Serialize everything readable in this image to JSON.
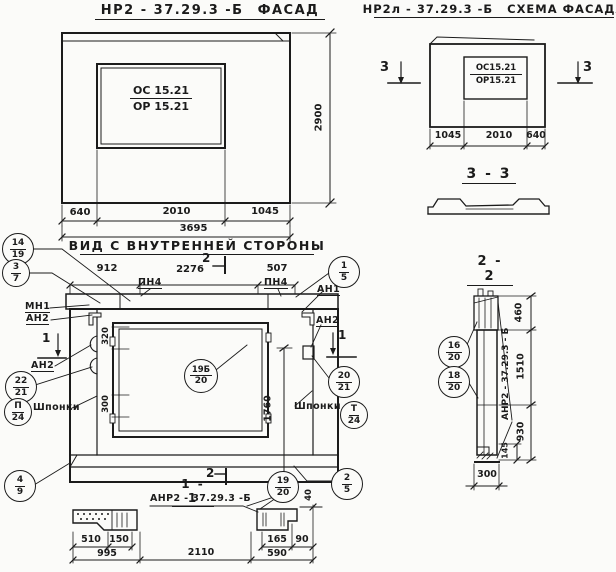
{
  "facade": {
    "title_number": "НР2 - 37.29.3  -Б",
    "title_word": "ФАСАД",
    "window_mark_top": "ОС 15.21",
    "window_mark_bottom": "ОР 15.21",
    "dim_height": "2900",
    "dim_left": "640",
    "dim_mid": "2010",
    "dim_right": "1045",
    "dim_total": "3695"
  },
  "scheme": {
    "title_number": "НР2л - 37.29.3  -Б",
    "title_word": "СХЕМА ФАСАДА",
    "window_mark_top": "ОС15.21",
    "window_mark_bottom": "ОР15.21",
    "dim_left": "1045",
    "dim_mid": "2010",
    "dim_right": "640",
    "section_mark": "3"
  },
  "section33": {
    "title": "3 - 3"
  },
  "section22": {
    "title": "2 - 2",
    "dim_top": "460",
    "dim_mid": "1510",
    "dim_bottom": "930",
    "dim_small": "145",
    "dim_width": "300",
    "panel_label": "АНР2 - 37.29.3 - Б",
    "callout_upper": {
      "top": "16",
      "bottom": "20"
    },
    "callout_lower": {
      "top": "18",
      "bottom": "20"
    }
  },
  "inner_view": {
    "title": "ВИД С ВНУТРЕННЕЙ  СТОРОНЫ",
    "dim_left": "912",
    "dim_mid": "2276",
    "dim_right": "507",
    "dim_height": "1760",
    "dim_hinge_top": "320",
    "dim_hinge_bottom": "300",
    "section_mark_1": "1",
    "section_mark_2": "2",
    "labels": {
      "pn4": "ПН4",
      "mn1": "МН1",
      "an1": "АН1",
      "an2": "АН2",
      "shponki": "Шпонки"
    },
    "callouts": {
      "c14_19": {
        "top": "14",
        "bottom": "19"
      },
      "c3_7": {
        "top": "3",
        "bottom": "7"
      },
      "c22_21": {
        "top": "22",
        "bottom": "21"
      },
      "cp_24": {
        "top": "П",
        "bottom": "24"
      },
      "c4_9": {
        "top": "4",
        "bottom": "9"
      },
      "c1_5": {
        "top": "1",
        "bottom": "5"
      },
      "c20_21": {
        "top": "20",
        "bottom": "21"
      },
      "ct_24": {
        "top": "Т",
        "bottom": "24"
      },
      "c2_5": {
        "top": "2",
        "bottom": "5"
      },
      "c19b_20": {
        "top": "19Б",
        "bottom": "20"
      }
    }
  },
  "section11": {
    "title": "1 - 1",
    "label": "АНР2 - 37.29.3  -Б",
    "dims": {
      "d510": "510",
      "d150": "150",
      "d995": "995",
      "d2110": "2110",
      "d165": "165",
      "d90": "90",
      "d590": "590",
      "d40": "40"
    },
    "callouts": {
      "c19_20": {
        "top": "19",
        "bottom": "20"
      }
    }
  }
}
